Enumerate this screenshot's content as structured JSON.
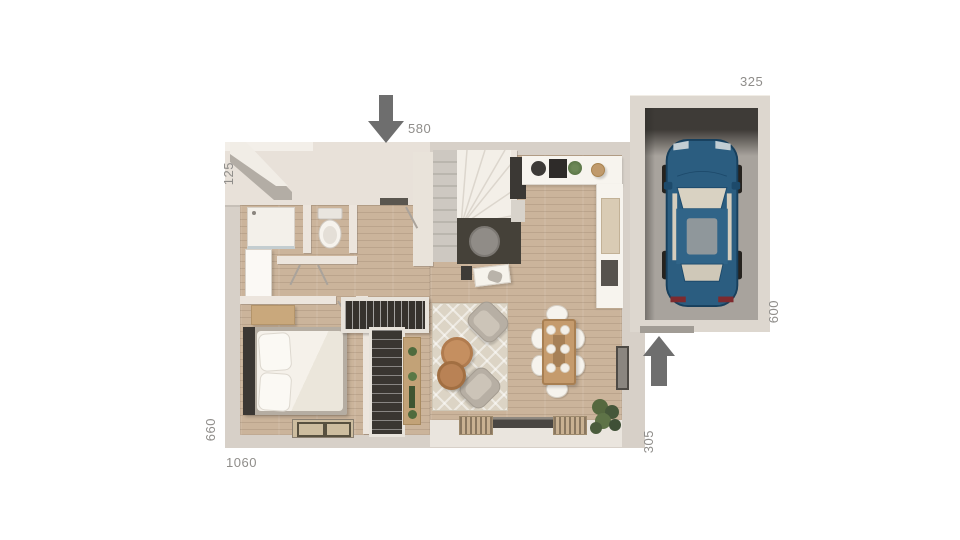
{
  "plan": {
    "dimensions": {
      "front_entry": "580",
      "garage_top": "325",
      "left_upper": "125",
      "left_lower": "660",
      "bottom_total": "1060",
      "right_lower": "305",
      "garage_right": "600"
    },
    "colors": {
      "background": "#ffffff",
      "exterior_wall": "#d7d0c8",
      "front_wall_face": "#e8e1d9",
      "wood_floor": "#cbb49b",
      "garage_floor": "#a8a39d",
      "garage_shadow": "#3e3b37",
      "car_body": "#2b5d80",
      "direction_arrow": "#6e6e6e",
      "dimension_text": "#8f8d8a",
      "dark_nook_floor": "#454139"
    }
  }
}
